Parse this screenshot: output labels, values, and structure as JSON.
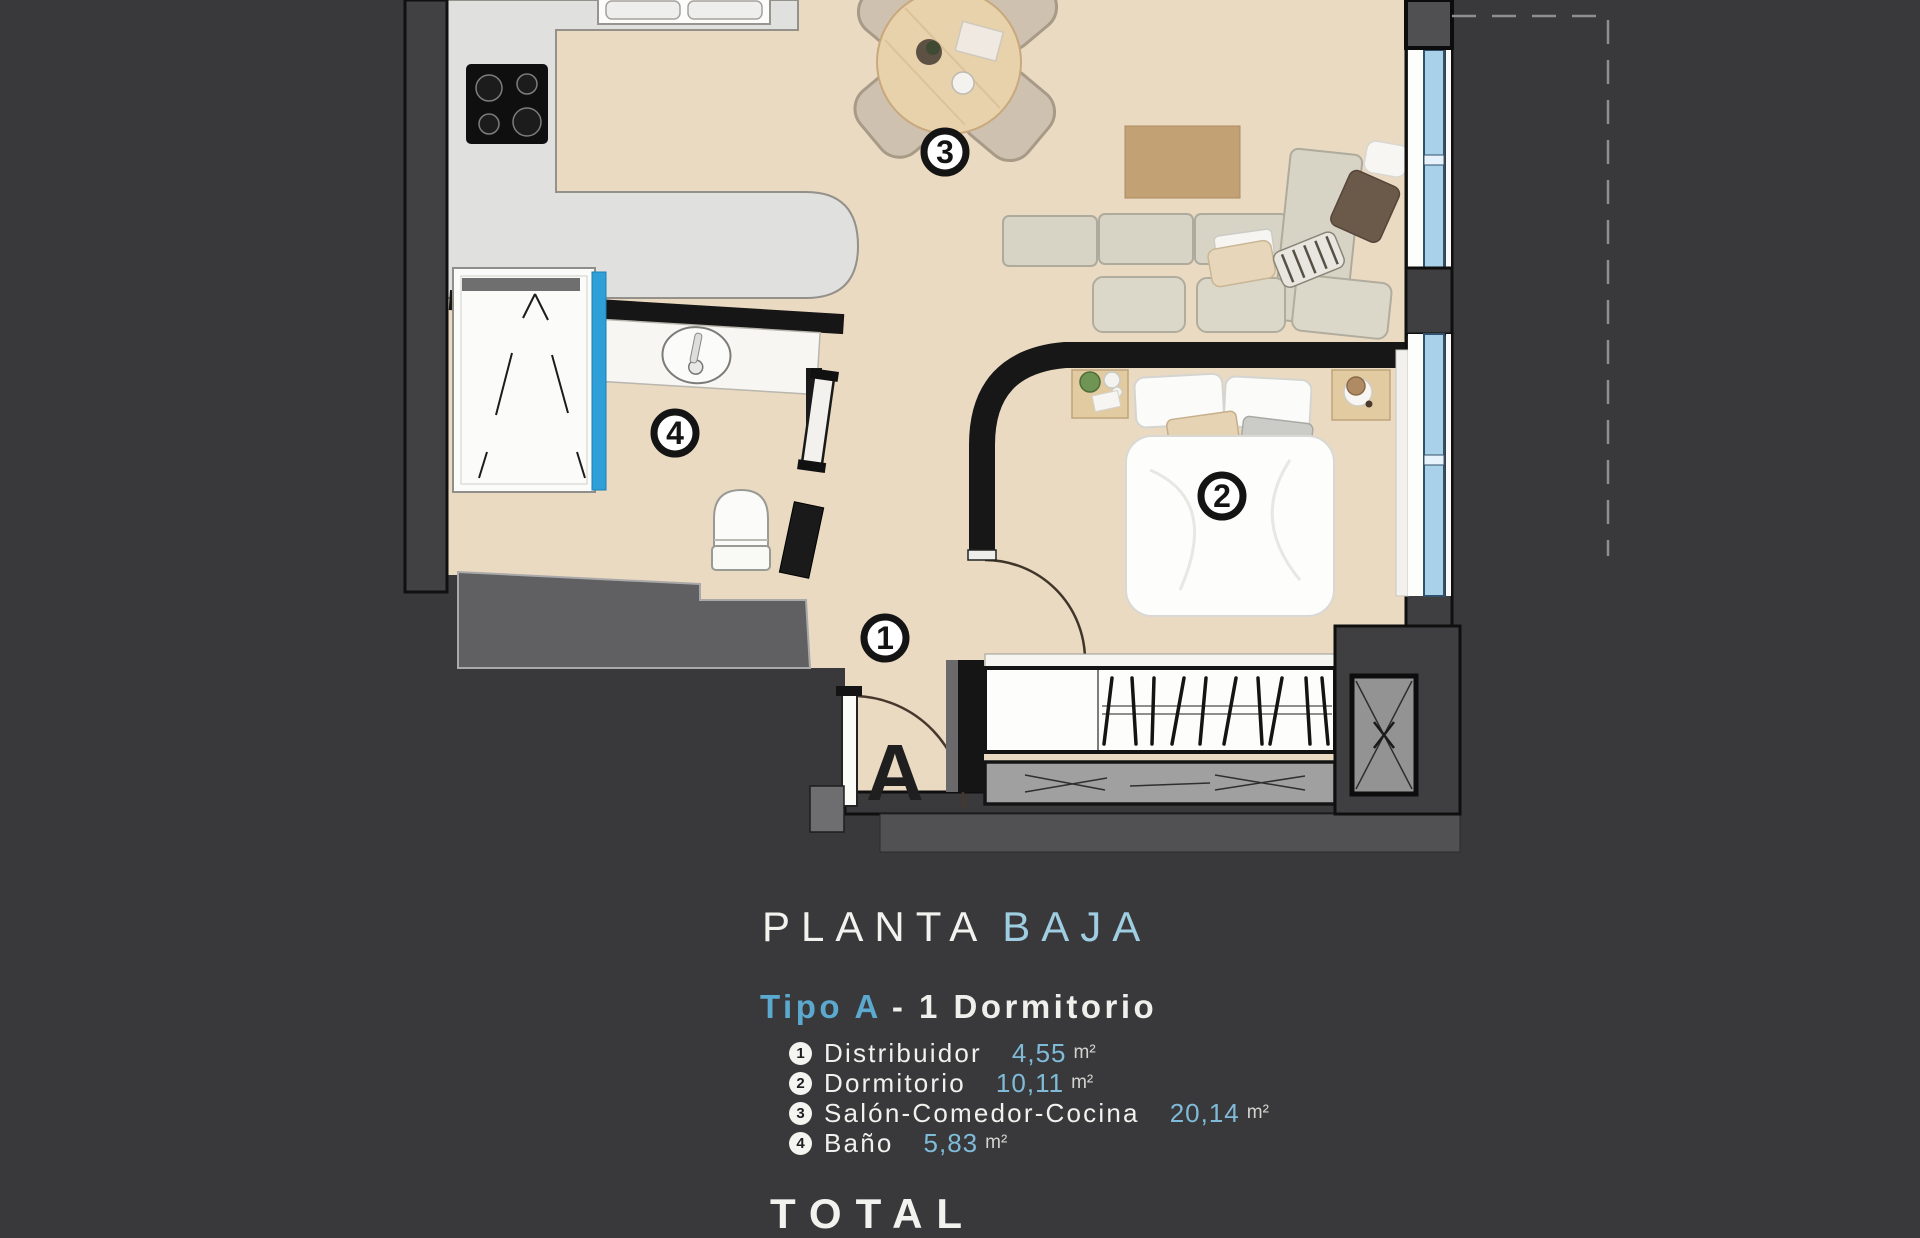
{
  "title": {
    "main": "PLANTA",
    "accent": "BAJA"
  },
  "subtitle": {
    "accent": "Tipo A",
    "rest": "- 1  Dormitorio"
  },
  "legend": {
    "items": [
      {
        "num": "1",
        "name": "Distribuidor",
        "area": "4,55",
        "unit": "m²"
      },
      {
        "num": "2",
        "name": "Dormitorio",
        "area": "10,11",
        "unit": "m²"
      },
      {
        "num": "3",
        "name": "Salón-Comedor-Cocina",
        "area": "20,14",
        "unit": "m²"
      },
      {
        "num": "4",
        "name": "Baño",
        "area": "5,83",
        "unit": "m²"
      }
    ]
  },
  "footer": {
    "total_label": "TOTAL"
  },
  "plan": {
    "unit_letter": "A",
    "room_numbers": [
      "1",
      "2",
      "3",
      "4"
    ]
  },
  "colors": {
    "background": "#39393b",
    "floor_beige": "#ebdac2",
    "kitchen_gray": "#e0e0df",
    "wall_dark": "#3f3f41",
    "accent_blue_title": "#9fcde2",
    "accent_blue_values": "#7fbbd9",
    "window_glass": "#a9d2ea",
    "shower_glass": "#2f9fd8",
    "text_white": "#f1f1ee"
  }
}
